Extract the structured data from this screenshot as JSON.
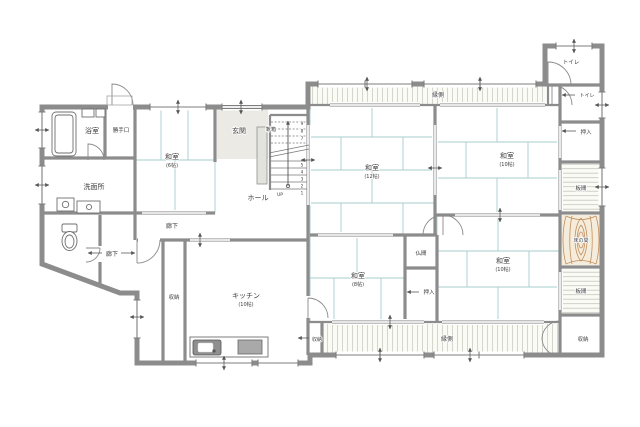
{
  "colors": {
    "wall": "#8c8c8c",
    "tatami_line": "#a5cdcc",
    "engawa_hatch": "#ccccc3",
    "itama_stripe": "#c6c6bd",
    "wood_grain": "#c08f5f",
    "tokonoma_floor": "#f6ecdb",
    "genkan_floor": "#eceae4",
    "text": "#3c3c3c"
  },
  "rooms": {
    "washitsu_nw": {
      "label": "和室",
      "size": "(6帖)"
    },
    "washitsu_c": {
      "label": "和室",
      "size": "(12帖)"
    },
    "washitsu_ne": {
      "label": "和室",
      "size": "(10帖)"
    },
    "washitsu_se": {
      "label": "和室",
      "size": "(10帖)"
    },
    "washitsu_s": {
      "label": "和室",
      "size": "(8帖)"
    },
    "kitchen": {
      "label": "キッチン",
      "size": "(10帖)"
    },
    "genkan": {
      "label": "玄関"
    },
    "hall": {
      "label": "ホール"
    },
    "bath": {
      "label": "浴室"
    },
    "katteguchi": {
      "label": "勝手口"
    },
    "senmenjo": {
      "label": "洗面所"
    },
    "toilet_top": {
      "label": "トイレ"
    },
    "toilet_right": {
      "label": "トイレ"
    },
    "oshiire_right": {
      "label": "押入"
    },
    "oshiire_c": {
      "label": "押入"
    },
    "butsuma": {
      "label": "仏間"
    },
    "itama_upper": {
      "label": "板間"
    },
    "itama_lower": {
      "label": "板間"
    },
    "tokonoma": {
      "label": "床の間"
    },
    "storage_se": {
      "label": "収納"
    },
    "storage_tall": {
      "label": "収納"
    },
    "storage_engawa": {
      "label": "収納"
    },
    "engawa_top": {
      "label": "縁側"
    },
    "engawa_bottom": {
      "label": "縁側"
    },
    "roka_main": {
      "label": "廊下"
    },
    "roka_west": {
      "label": "廊下"
    },
    "kutsubako": {
      "label": "靴箱"
    }
  },
  "stairs": {
    "up_label": "UP",
    "upper_steps": [
      "9",
      "8",
      "7"
    ],
    "lower_steps": [
      "5",
      "4",
      "3",
      "2",
      "1"
    ]
  }
}
